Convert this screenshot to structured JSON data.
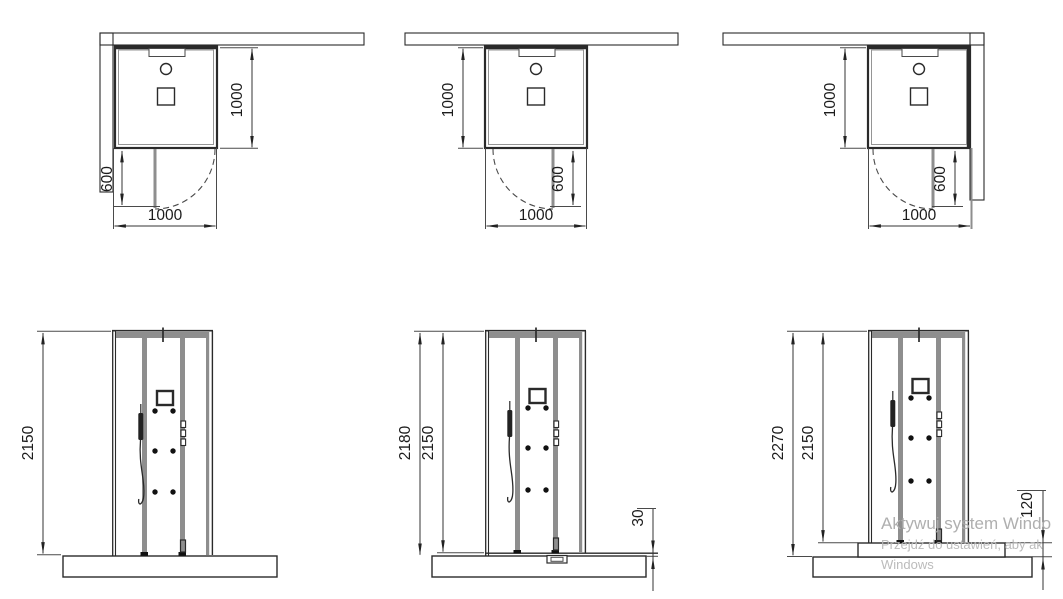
{
  "drawing": {
    "title": "Shower cabin installation dimension drawing",
    "colors": {
      "line": "#2a2a2a",
      "frame_gray": "#8e8e8e",
      "watermark_gray": "#b4b4b4",
      "background": "#ffffff"
    },
    "top_views": [
      {
        "name": "corner-left-installation",
        "walls": "left and top",
        "width": "1000",
        "depth": "1000",
        "door_opening": "600"
      },
      {
        "name": "back-wall-installation",
        "walls": "top",
        "width": "1000",
        "depth": "1000",
        "door_opening": "600"
      },
      {
        "name": "corner-right-installation",
        "walls": "top and right",
        "width": "1000",
        "depth": "1000",
        "door_opening": "600"
      }
    ],
    "front_views": [
      {
        "name": "cabin-on-floor",
        "height": "2150"
      },
      {
        "name": "cabin-on-tray",
        "overall": "2180",
        "cabin": "2150",
        "base": "30"
      },
      {
        "name": "cabin-on-plinth",
        "overall": "2270",
        "cabin": "2150",
        "base": "120"
      }
    ],
    "watermark": {
      "line1": "Aktywuj system Windo",
      "line2": "Przejdź do ustawień, aby ak",
      "line3": "Windows"
    }
  }
}
